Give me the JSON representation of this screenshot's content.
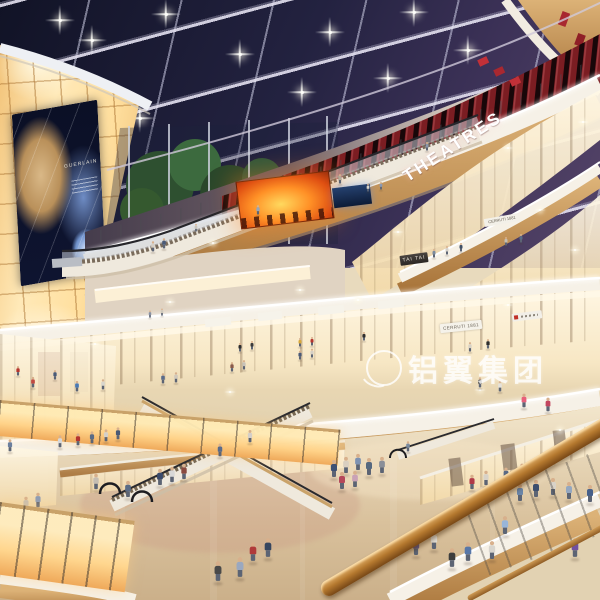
{
  "meta": {
    "type": "architectural-rendering",
    "subject": "Multi-level shopping mall atrium interior at night, 3D visualization"
  },
  "signs": {
    "theatres": "THEATRES",
    "tai_tai": "TAI TAI",
    "cerruti": "CERRUTI 1881",
    "billboard_brand": "GUERLAIN",
    "watermark": "铝翼集团"
  },
  "colors": {
    "sky_top": "#111326",
    "sky_horizon": "#564569",
    "slat_red": "#a82830",
    "fire_orange": "#ff9026",
    "wall_glow": "#ffdf9e",
    "wood": "#c89a5c",
    "fascia_white": "#f6f1e7",
    "floor": "#e6d7ba",
    "handrail": "#b5792f"
  },
  "scene": {
    "lights_ceiling": [
      [
        92,
        40
      ],
      [
        166,
        14
      ],
      [
        240,
        54
      ],
      [
        302,
        92
      ],
      [
        330,
        32
      ],
      [
        388,
        78
      ],
      [
        414,
        12
      ],
      [
        468,
        50
      ],
      [
        140,
        118
      ],
      [
        60,
        20
      ]
    ],
    "sparkles": [
      [
        508,
        148
      ],
      [
        583,
        122
      ],
      [
        213,
        243
      ],
      [
        398,
        232
      ],
      [
        508,
        305
      ],
      [
        300,
        290
      ],
      [
        95,
        344
      ],
      [
        170,
        302
      ],
      [
        480,
        390
      ],
      [
        230,
        392
      ],
      [
        560,
        430
      ],
      [
        358,
        300
      ],
      [
        540,
        210
      ],
      [
        575,
        250
      ]
    ],
    "people": [
      [
        334,
        478,
        1,
        "#3d5074"
      ],
      [
        346,
        474,
        0.95,
        "#d9cfc0"
      ],
      [
        358,
        471,
        0.95,
        "#7d92b2"
      ],
      [
        369,
        476,
        1,
        "#55687f"
      ],
      [
        342,
        490,
        1,
        "#b5485a"
      ],
      [
        355,
        488,
        0.95,
        "#c9a2b6"
      ],
      [
        382,
        474,
        0.95,
        "#8a8f98"
      ],
      [
        253,
        562,
        1.1,
        "#b03a3a"
      ],
      [
        268,
        558,
        1.1,
        "#36455f"
      ],
      [
        416,
        556,
        1.05,
        "#6b5f8a"
      ],
      [
        434,
        550,
        1.05,
        "#e2ded5"
      ],
      [
        160,
        486,
        0.95,
        "#3a4a6b"
      ],
      [
        172,
        483,
        0.9,
        "#d8d8d8"
      ],
      [
        184,
        480,
        0.9,
        "#8a4a3f"
      ],
      [
        128,
        498,
        0.95,
        "#5a6b85"
      ],
      [
        96,
        490,
        0.9,
        "#c5bdb2"
      ],
      [
        520,
        502,
        1,
        "#6b86a8"
      ],
      [
        536,
        498,
        1,
        "#3e4f6e"
      ],
      [
        553,
        496,
        1,
        "#d8d2c8"
      ],
      [
        569,
        500,
        1,
        "#94a7c0"
      ],
      [
        590,
        503,
        1,
        "#47608a"
      ],
      [
        505,
        535,
        1.05,
        "#98b5d8"
      ],
      [
        452,
        568,
        1.1,
        "#3d3d3d"
      ],
      [
        468,
        562,
        1.1,
        "#5877a8"
      ],
      [
        492,
        560,
        1.05,
        "#d8d5ce"
      ],
      [
        575,
        558,
        1.1,
        "#7050a0"
      ],
      [
        218,
        582,
        1.15,
        "#4a4a4a"
      ],
      [
        240,
        578,
        1.15,
        "#9aa8c0"
      ],
      [
        26,
        512,
        0.85,
        "#c5bdb2"
      ],
      [
        38,
        508,
        0.85,
        "#8a9ab5"
      ],
      [
        10,
        452,
        0.7,
        "#6b7f9e"
      ],
      [
        60,
        448,
        0.7,
        "#d8d8d8"
      ],
      [
        78,
        446,
        0.7,
        "#b5342e"
      ],
      [
        92,
        444,
        0.7,
        "#5a6b85"
      ],
      [
        106,
        442,
        0.7,
        "#d5d0c8"
      ],
      [
        118,
        440,
        0.7,
        "#4a5a75"
      ],
      [
        33,
        388,
        0.62,
        "#c04a42"
      ],
      [
        77,
        392,
        0.62,
        "#4a7ab5"
      ],
      [
        103,
        390,
        0.6,
        "#d8d5cc"
      ],
      [
        163,
        384,
        0.6,
        "#5a6b8a"
      ],
      [
        176,
        383,
        0.6,
        "#d0c8bb"
      ],
      [
        232,
        372,
        0.55,
        "#8a5a4a"
      ],
      [
        244,
        370,
        0.55,
        "#c8c2b8"
      ],
      [
        300,
        360,
        0.52,
        "#4a5a78"
      ],
      [
        312,
        358,
        0.52,
        "#d5cfc5"
      ],
      [
        524,
        408,
        0.8,
        "#e8607a"
      ],
      [
        548,
        412,
        0.8,
        "#c2455f"
      ],
      [
        500,
        392,
        0.62,
        "#e5e2da"
      ],
      [
        480,
        388,
        0.6,
        "#3a3a3a"
      ],
      [
        472,
        490,
        0.85,
        "#b03a48"
      ],
      [
        486,
        486,
        0.85,
        "#d8d2c8"
      ],
      [
        506,
        482,
        0.8,
        "#5a6b85"
      ],
      [
        522,
        478,
        0.8,
        "#d5cfc3"
      ],
      [
        368,
        192,
        0.45,
        "#d8d5cc"
      ],
      [
        381,
        190,
        0.45,
        "#8a9ab5"
      ],
      [
        196,
        232,
        0.45,
        "#c8c4bb"
      ],
      [
        153,
        252,
        0.6,
        "#d5cfc5"
      ],
      [
        164,
        249,
        0.6,
        "#4a5a78"
      ],
      [
        258,
        215,
        0.55,
        "#97a5b8"
      ],
      [
        340,
        184,
        0.55,
        "#b5aa9a"
      ],
      [
        427,
        151,
        0.5,
        "#8a96aa"
      ],
      [
        220,
        457,
        0.75,
        "#5a6b8a"
      ],
      [
        250,
        443,
        0.72,
        "#d5cfc8"
      ],
      [
        408,
        452,
        0.6,
        "#7a8a9e"
      ],
      [
        434,
        258,
        0.5,
        "#7a8a9e"
      ],
      [
        447,
        255,
        0.5,
        "#d5d0c8"
      ],
      [
        461,
        252,
        0.5,
        "#3f4f66"
      ],
      [
        506,
        246,
        0.5,
        "#c5beb2"
      ],
      [
        521,
        243,
        0.5,
        "#5a6b85"
      ],
      [
        240,
        352,
        0.5,
        "#2e2e2e"
      ],
      [
        252,
        350,
        0.5,
        "#3a3a3a"
      ],
      [
        300,
        347,
        0.5,
        "#d8a83a"
      ],
      [
        312,
        346,
        0.5,
        "#b5352e"
      ],
      [
        364,
        341,
        0.5,
        "#2e2e2e"
      ],
      [
        470,
        352,
        0.55,
        "#d8d2c5"
      ],
      [
        488,
        349,
        0.55,
        "#2e2e2e"
      ],
      [
        55,
        380,
        0.55,
        "#4a5a78"
      ],
      [
        18,
        376,
        0.55,
        "#b5352e"
      ],
      [
        150,
        318,
        0.42,
        "#8a93a5"
      ],
      [
        162,
        316,
        0.42,
        "#cfc9bd"
      ]
    ]
  }
}
